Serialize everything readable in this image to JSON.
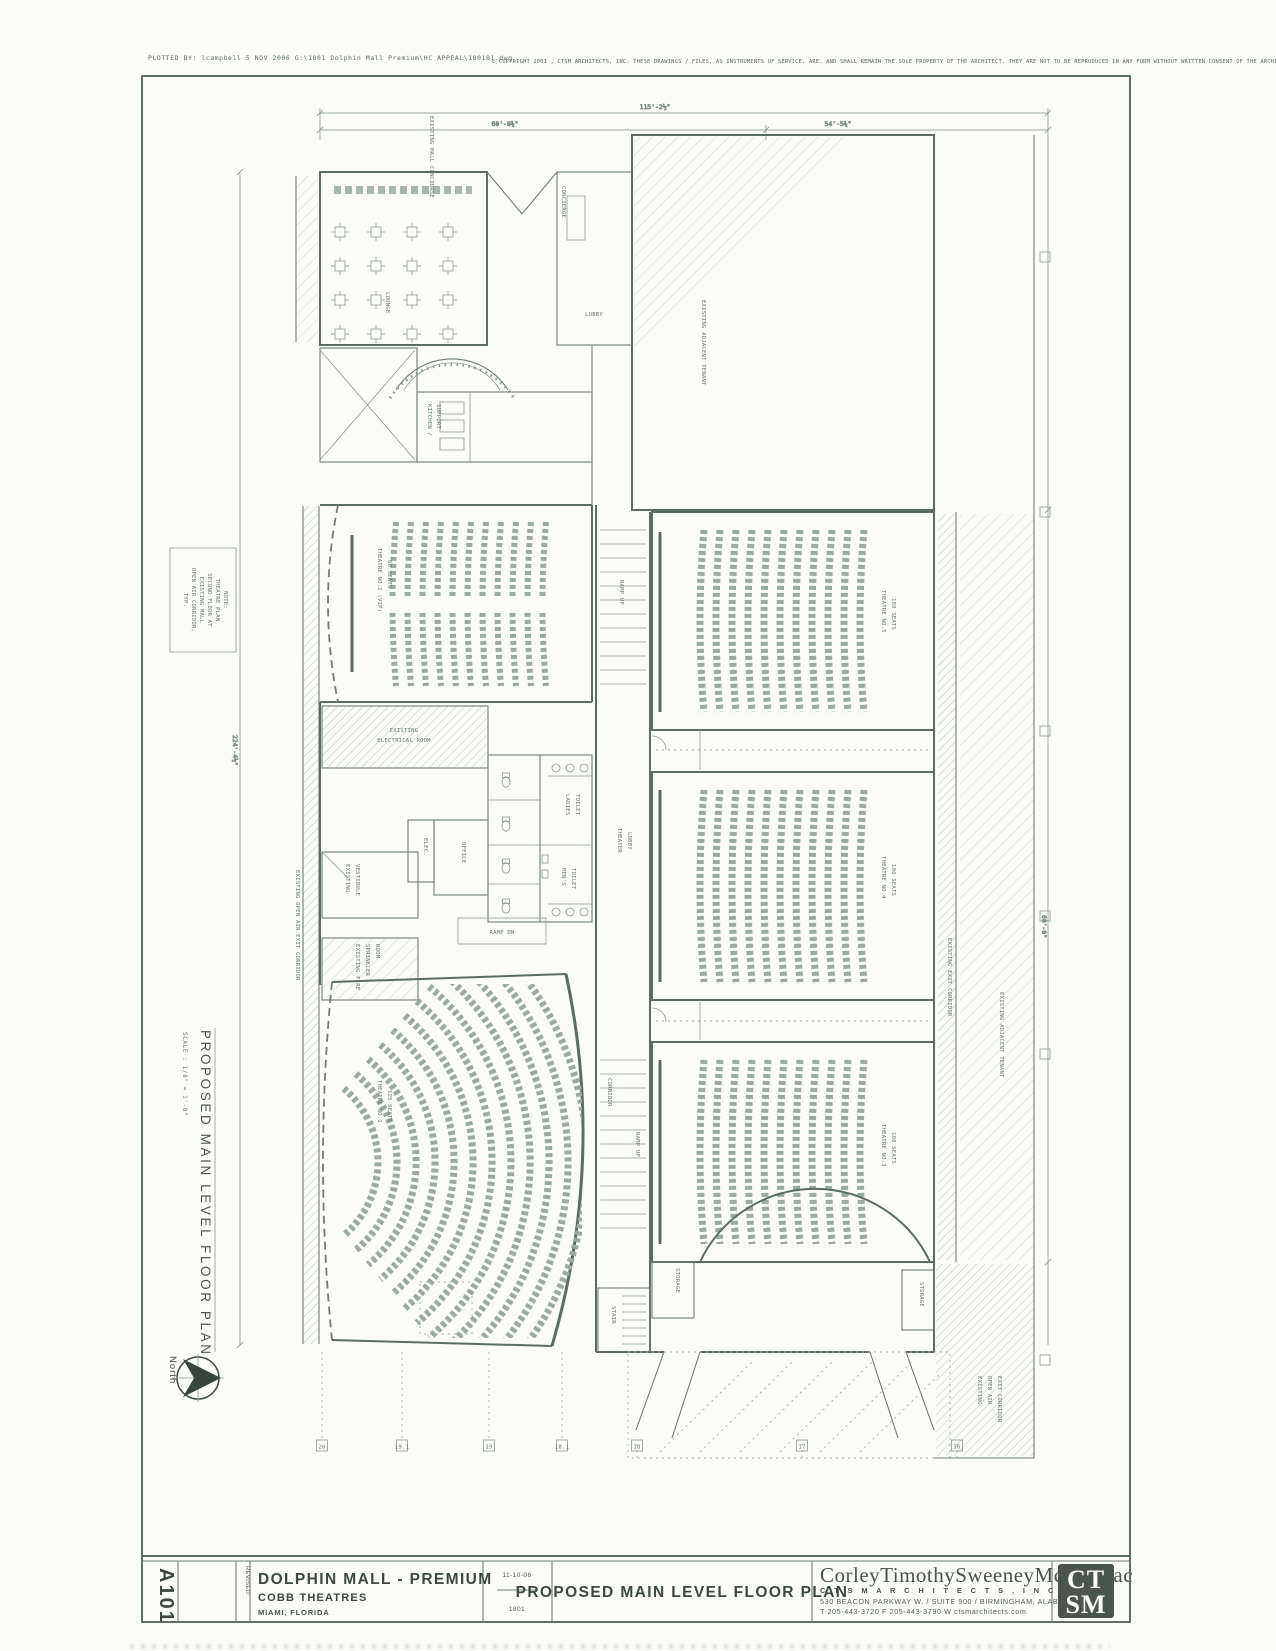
{
  "scan": {
    "plot_header": "PLOTTED   BY:  lcampbell    5  NOV  2006     G:\\1801  Dolphin  Mall  Premium\\HC  APPEAL\\180181.dwg",
    "copyright": "© COPYRIGHT   2001  ,  CTSM  ARCHITECTS,  INC.  THESE  DRAWINGS  /  FILES,  AS  INSTRUMENTS  OF  SERVICE,  ARE,  AND  SHALL  REMAIN  THE  SOLE  PROPERTY  OF  THE  ARCHITECT.  THEY  ARE  NOT  TO  BE  REPRODUCED  IN  ANY  FORM  WITHOUT  WRITTEN  CONSENT  OF  THE  ARCHITECT."
  },
  "margin": {
    "drawing_title": "PROPOSED  MAIN  LEVEL  FLOOR  PLAN",
    "scale": "SCALE : 1/8\" = 1'-0\"",
    "north_label": "North",
    "note": {
      "l1": "NOTE:",
      "l2": "THEATRE PLAN",
      "l3": "SECOND FLOOR AT",
      "l4": "EXISTING MALL",
      "l5": "OPEN AIR CORRIDOR,",
      "l6": "TYP."
    }
  },
  "plan": {
    "dims": {
      "overall": "115'-2½\"",
      "seg_left": "60'-8¾\"",
      "seg_right": "54'-5¾\"",
      "side_left": "224'-4½\"",
      "side_right": "60'-0\""
    },
    "grid_bottom": [
      "20",
      "19.1",
      "19",
      "18.1",
      "18",
      "17",
      "16"
    ],
    "rooms": {
      "mall_concourse": "EXISTING MALL CONCOURSE",
      "lounge": "LOUNGE",
      "concierge": "CONCIERGE",
      "lobby": "LOBBY",
      "kitchen_l1": "KITCHEN /",
      "kitchen_l2": "SUPPORT",
      "adjacent_tenant": "EXISTING ADJACENT TENANT",
      "t1_l1": "THEATRE NO.1",
      "t1_l2": "125 SEATS",
      "t2_l1": "THEATRE NO.2 (VIP)",
      "t2_l2": "60 SEATS",
      "t3_l1": "THEATRE NO.3",
      "t3_l2": "180 SEATS",
      "t4_l1": "THEATRE NO.4",
      "t4_l2": "180 SEATS",
      "t5_l1": "THEATRE NO.5",
      "t5_l2": "180 SEATS",
      "ramp_up": "RAMP UP",
      "ramp_dn": "RAMP DN",
      "corridor": "CORRIDOR",
      "theater_lobby_l1": "THEATER",
      "theater_lobby_l2": "LOBBY",
      "elec": "ELEC.",
      "office": "OFFICE",
      "ladies_l1": "LADIES",
      "ladies_l2": "TOILET",
      "mens_l1": "MEN'S",
      "mens_l2": "TOILET",
      "ex_elec_l1": "EXISTING",
      "ex_elec_l2": "ELECTRICAL ROOM",
      "ex_vest_l1": "EXISTING",
      "ex_vest_l2": "VESTIBULE",
      "ex_fire_l1": "EXISTING FIRE",
      "ex_fire_l2": "SPRINKLER",
      "ex_fire_l3": "ROOM",
      "ex_open_air": "EXISTING OPEN AIR EXIT CORRIDOR",
      "ex_exit_corridor": "EXISTING EXIT CORRIDOR",
      "ex_oa_l1": "EXISTING",
      "ex_oa_l2": "OPEN AIR",
      "ex_oa_l3": "EXIT CORRIDOR",
      "storage": "STORAGE",
      "stair": "STAIR"
    }
  },
  "titleblock": {
    "sheet_number": "A101",
    "revised_label": "REVISED:",
    "project_name": "DOLPHIN MALL - PREMIUM",
    "client": "COBB THEATRES",
    "location": "MIAMI, FLORIDA",
    "date": "11-10-06",
    "job_number": "1801",
    "sheet_title": "PROPOSED MAIN LEVEL FLOOR PLAN",
    "firm_name": "CorleyTimothySweeneyMcCormac",
    "firm_sub": "C T S M    A R C H I T E C T S ,    I N C .",
    "firm_address": "530 BEACON PARKWAY W. / SUITE 900 / BIRMINGHAM, ALABAMA 35209",
    "firm_contact": "T 205-443-3720     F 205-443-3790     W ctsmarchitects.com",
    "logo_top": "CT",
    "logo_bottom": "SM"
  }
}
